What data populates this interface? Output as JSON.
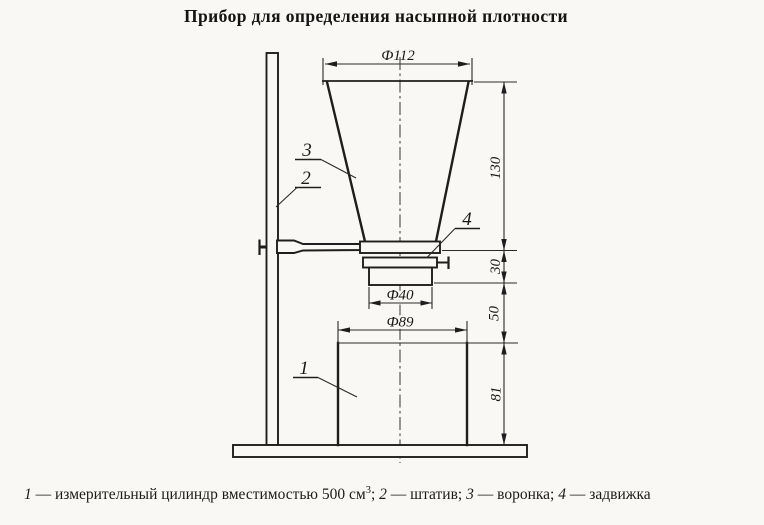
{
  "title": "Прибор для определения насыпной плотности",
  "colors": {
    "background": "#f9f8f4",
    "ink": "#1e1e1e"
  },
  "diagram": {
    "dimensions": {
      "funnel_top_diameter": "Ф112",
      "funnel_height": "130",
      "gate_section_height": "30",
      "outlet_diameter": "Ф40",
      "drop_height": "50",
      "cylinder_diameter": "Ф89",
      "cylinder_height": "81"
    },
    "part_labels": {
      "cylinder": "1",
      "stand": "2",
      "funnel": "3",
      "gate": "4"
    }
  },
  "caption": {
    "items": [
      {
        "num": "1",
        "text": " — измерительный цилиндр вместимостью 500 см"
      },
      {
        "num": "2",
        "text": " — штатив; "
      },
      {
        "num": "3",
        "text": " — воронка; "
      },
      {
        "num": "4",
        "text": " — задвижка"
      }
    ],
    "superscript": "3",
    "after_superscript": "; "
  }
}
